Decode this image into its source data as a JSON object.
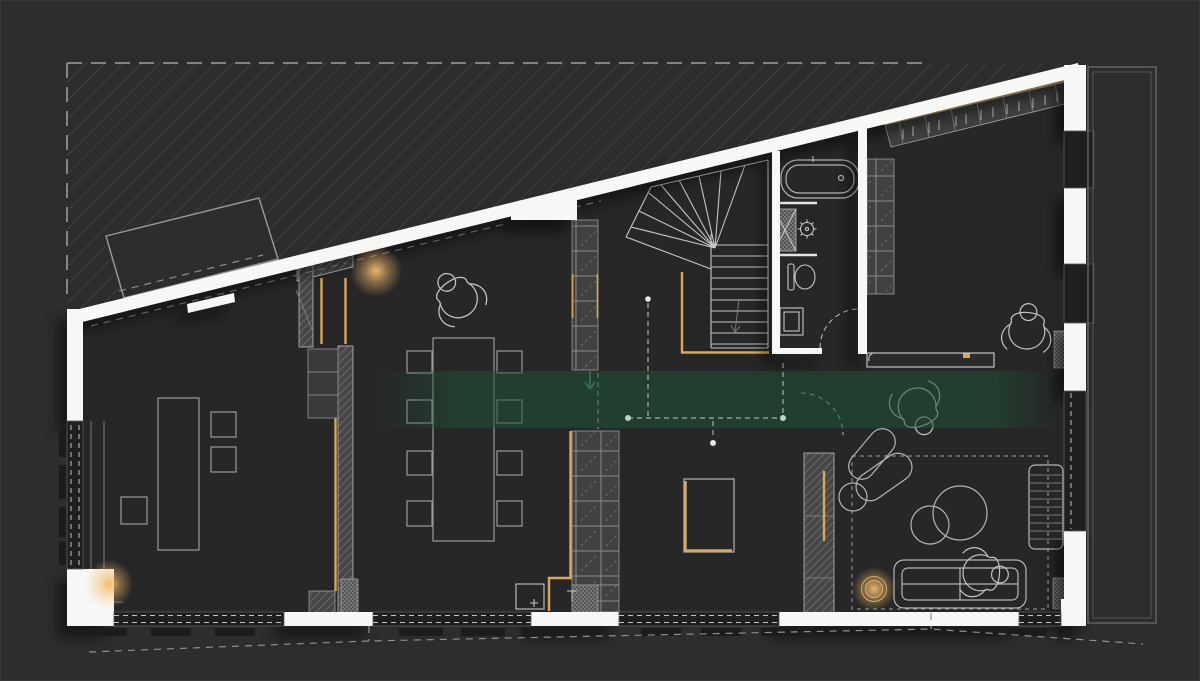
{
  "meta": {
    "description": "Dark architectural ground-floor plan drawing (CAD style), no text labels visible",
    "canvas": {
      "width": 1200,
      "height": 681
    }
  },
  "colors": {
    "bg": "#2d2d2d",
    "floor": "#272727",
    "wall": "#f7f7f5",
    "line": "#9a9a9a",
    "line_light": "#c6c6c6",
    "line_dim": "#7a7a7a",
    "hatch": "#4d4d4d",
    "amber": "#d9a75e",
    "glow": "#f4bc6d",
    "green_zone": "#1c5236",
    "dash": "#8f8f8f",
    "recess": "#1f1f1f",
    "cell_fill": "#414141",
    "cell_line": "#8a8a8a",
    "dark_tick": "#1c1c1c"
  },
  "elements": {
    "zones": [
      "hatched-site-area",
      "green-lighting-zone",
      "entry-platform"
    ],
    "rooms": [
      "studio-room",
      "dining-room",
      "kitchen",
      "stair-hall",
      "bathroom",
      "dressing-area",
      "living-room"
    ],
    "furniture": [
      "dining-table",
      "dining-chairs",
      "studio-table",
      "studio-chairs",
      "kitchen-island",
      "kitchen-counter",
      "sofa",
      "armchair",
      "coffee-tables",
      "slatted-console",
      "wardrobe",
      "closet-column",
      "shelf-columns",
      "rug"
    ],
    "fixtures": [
      "bathtub",
      "shower",
      "toilet",
      "washbasin",
      "sink-cabinet",
      "winder-staircase"
    ],
    "people_figures": 4,
    "light_glows": 3,
    "door_arcs": 2
  }
}
